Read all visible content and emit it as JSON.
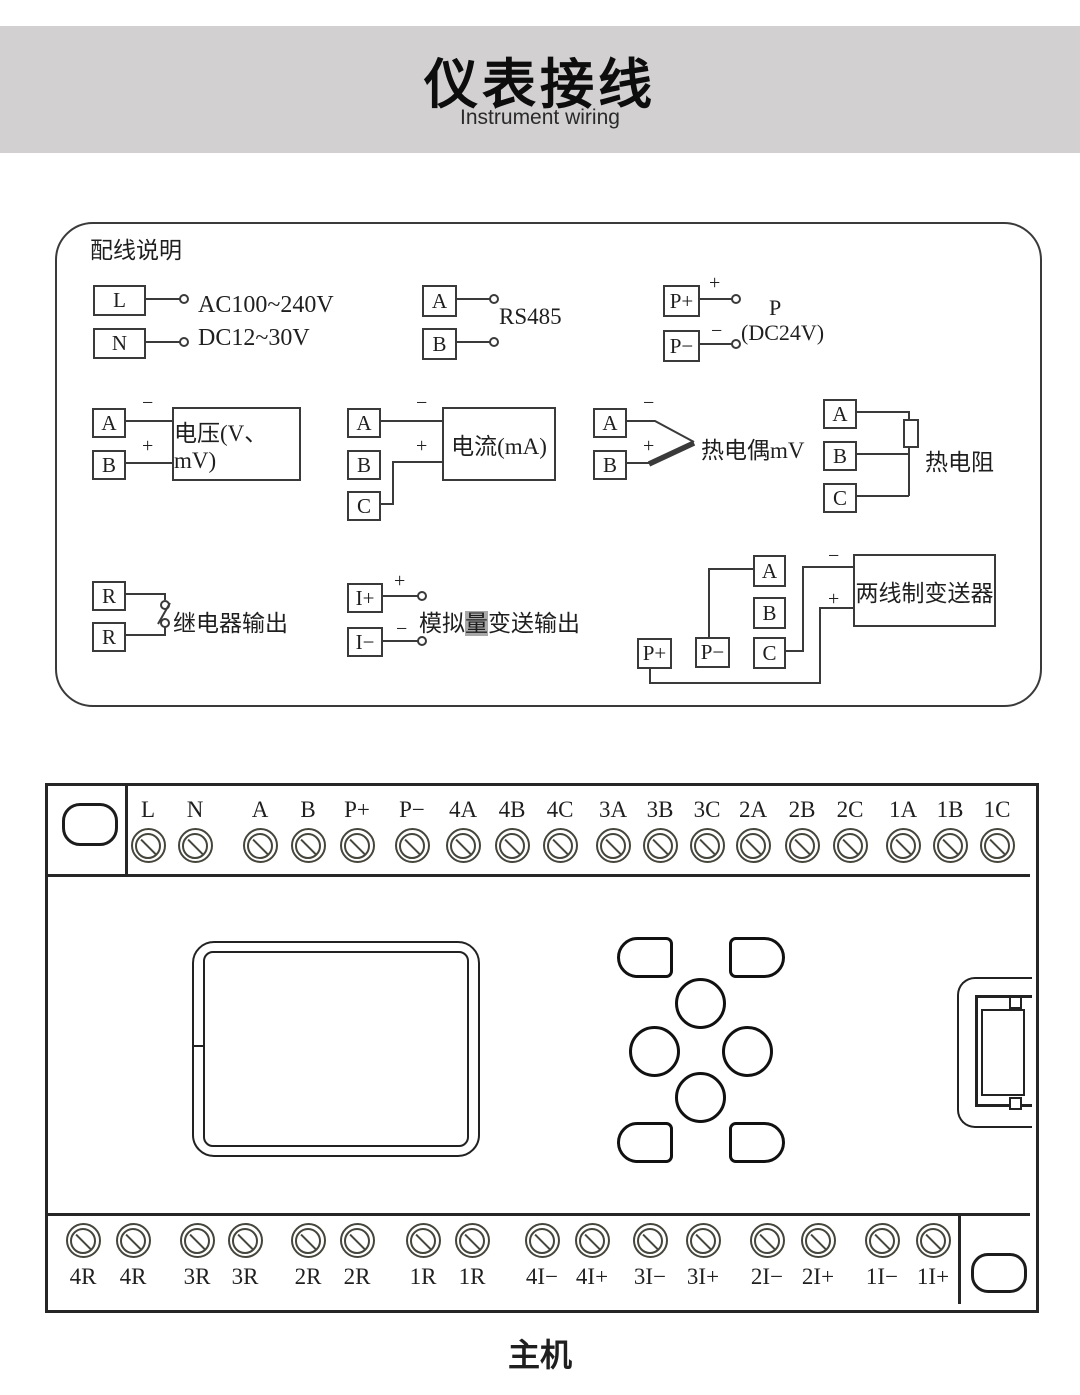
{
  "header": {
    "title": "仪表接线",
    "subtitle": "Instrument wiring"
  },
  "signs": {
    "plus": "+",
    "minus": "−"
  },
  "config": {
    "title": "配线说明",
    "power": {
      "t1": "L",
      "t2": "N",
      "line1": "AC100~240V",
      "line2": "DC12~30V"
    },
    "rs485": {
      "t1": "A",
      "t2": "B",
      "label": "RS485"
    },
    "aux": {
      "t1": "P+",
      "t2": "P−",
      "name": "P",
      "spec": "(DC24V)"
    },
    "voltage": {
      "t1": "A",
      "t2": "B",
      "label": "电压(V、mV)"
    },
    "current": {
      "t1": "A",
      "t2": "B",
      "t3": "C",
      "label": "电流(mA)"
    },
    "thermocouple": {
      "t1": "A",
      "t2": "B",
      "label": "热电偶mV"
    },
    "rtd": {
      "t1": "A",
      "t2": "B",
      "t3": "C",
      "label": "热电阻"
    },
    "relay": {
      "t1": "R",
      "t2": "R",
      "label": "继电器输出"
    },
    "analog": {
      "t1": "I+",
      "t2": "I−",
      "label_pre": "模拟",
      "label_hl": "量",
      "label_post": "变送输出"
    },
    "transmitter": {
      "ta": "A",
      "tb": "B",
      "tc": "C",
      "tp1": "P+",
      "tp2": "P−",
      "label": "两线制变送器"
    }
  },
  "block": {
    "top": [
      "L",
      "N",
      "A",
      "B",
      "P+",
      "P−",
      "4A",
      "4B",
      "4C",
      "3A",
      "3B",
      "3C",
      "2A",
      "2B",
      "2C",
      "1A",
      "1B",
      "1C"
    ],
    "bottom": [
      "4R",
      "4R",
      "3R",
      "3R",
      "2R",
      "2R",
      "1R",
      "1R",
      "4I−",
      "4I+",
      "3I−",
      "3I+",
      "2I−",
      "2I+",
      "1I−",
      "1I+"
    ]
  },
  "footer": {
    "label": "主机"
  }
}
